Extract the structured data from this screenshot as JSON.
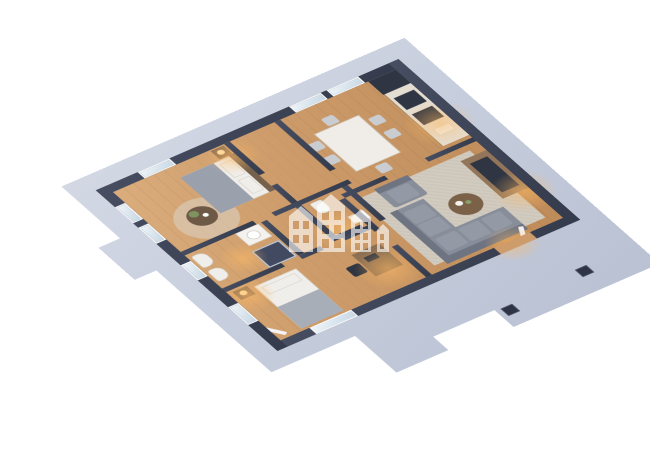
{
  "scene": {
    "type": "3d-floor-plan-render",
    "view": "isometric",
    "description": "Furnished apartment 3D floor plan on a light gray base platform with terrace",
    "background": "#ffffff"
  },
  "colors": {
    "platform": "#c7cedd",
    "platform_shadow": "#8c94a8",
    "walls": "#3b4254",
    "wood_floor": "#cd9c6a",
    "tile_floor": "#ddd3c6",
    "rug": "#d2cbbf",
    "sofa_gray": "#878d99",
    "marble_white": "#f0ede8",
    "kitchen_wood": "#b08a5e",
    "warm_light": "#ffba64",
    "window_glass": "#c7d8e5",
    "inlay_square": "#2e3443",
    "watermark_white": "#ffffff"
  },
  "rooms": [
    {
      "id": "master-bedroom",
      "name": "Master Bedroom",
      "floor": "wood"
    },
    {
      "id": "kitchen-dining",
      "name": "Kitchen / Dining",
      "floor": "wood"
    },
    {
      "id": "living-room",
      "name": "Living Room",
      "floor": "wood"
    },
    {
      "id": "bathroom",
      "name": "Bathroom",
      "floor": "tile"
    },
    {
      "id": "wc",
      "name": "WC",
      "floor": "tile"
    },
    {
      "id": "bedroom",
      "name": "Bedroom",
      "floor": "wood"
    },
    {
      "id": "hallway",
      "name": "Hallway",
      "floor": "wood"
    },
    {
      "id": "terrace",
      "name": "Terrace",
      "floor": "concrete"
    }
  ],
  "furniture": {
    "master_bedroom": [
      "double-bed",
      "pillows",
      "nightstand",
      "table-lamp",
      "round-side-table",
      "plant",
      "round-rug"
    ],
    "kitchen": [
      "kitchen-counter",
      "fridge",
      "cooker-hood",
      "cooktop",
      "sink",
      "dining-table",
      "dining-chairs-x6"
    ],
    "living_room": [
      "corner-sofa",
      "armchair",
      "coffee-table",
      "tv-console",
      "tv",
      "area-rug",
      "terrace-door"
    ],
    "bathroom": [
      "toilet",
      "bidet",
      "washbasin",
      "shower"
    ],
    "wc": [
      "toilet",
      "washbasin"
    ],
    "bedroom": [
      "single-bed",
      "nightstand",
      "table-lamp",
      "desk",
      "desk-chair",
      "curtain"
    ]
  },
  "watermark": {
    "name": "buildings-logo",
    "building_count": 4,
    "color": "#ffffff",
    "opacity": 0.62
  },
  "terrace_details": {
    "inlay_count": 2
  }
}
